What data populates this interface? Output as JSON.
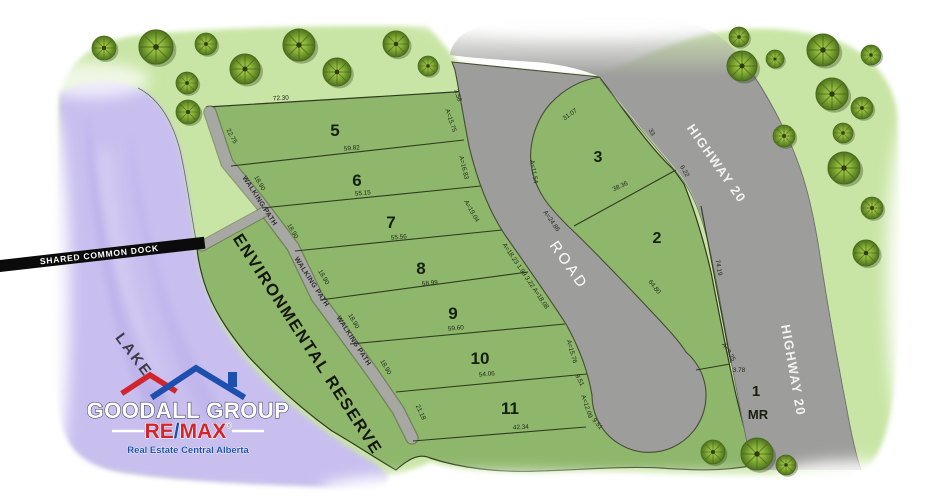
{
  "map": {
    "lake_label": "LAKE",
    "dock_label": "SHARED COMMON DOCK",
    "reserve_label": "ENVIRONMENTAL RESERVE",
    "road_label": "ROAD",
    "highway_labels": [
      {
        "text": "HIGHWAY 20",
        "x": 713,
        "y": 166,
        "r": 55
      },
      {
        "text": "HIGHWAY 20",
        "x": 789,
        "y": 371,
        "r": 80
      }
    ],
    "walking_path_labels": [
      {
        "text": "WALKING PATH",
        "x": 258,
        "y": 202,
        "r": 57
      },
      {
        "text": "WALKING PATH",
        "x": 310,
        "y": 283,
        "r": 57
      },
      {
        "text": "WALKING PATH",
        "x": 352,
        "y": 342,
        "r": 57
      }
    ],
    "lots": [
      {
        "number": "5",
        "x": 335,
        "y": 136,
        "s": 17
      },
      {
        "number": "6",
        "x": 357,
        "y": 186,
        "s": 17
      },
      {
        "number": "7",
        "x": 391,
        "y": 228,
        "s": 17
      },
      {
        "number": "8",
        "x": 421,
        "y": 274,
        "s": 17
      },
      {
        "number": "9",
        "x": 453,
        "y": 319,
        "s": 17
      },
      {
        "number": "10",
        "x": 480,
        "y": 364,
        "s": 17
      },
      {
        "number": "11",
        "x": 510,
        "y": 414,
        "s": 17
      },
      {
        "number": "3",
        "x": 598,
        "y": 162,
        "s": 16
      },
      {
        "number": "2",
        "x": 657,
        "y": 243,
        "s": 16
      },
      {
        "number": "1",
        "x": 756,
        "y": 396,
        "s": 15
      },
      {
        "number": "MR",
        "x": 758,
        "y": 419,
        "s": 13
      }
    ],
    "dimensions": [
      {
        "t": "72.30",
        "x": 281,
        "y": 100,
        "r": -4
      },
      {
        "t": "22.75",
        "x": 230,
        "y": 137,
        "r": 62
      },
      {
        "t": "3.58",
        "x": 456,
        "y": 96,
        "r": 72
      },
      {
        "t": "A=15.75",
        "x": 449,
        "y": 121,
        "r": 72
      },
      {
        "t": "59.82",
        "x": 352,
        "y": 150,
        "r": -5
      },
      {
        "t": "A=16.83",
        "x": 462,
        "y": 168,
        "r": 76
      },
      {
        "t": "55.15",
        "x": 363,
        "y": 195,
        "r": -5
      },
      {
        "t": "A=19.04",
        "x": 470,
        "y": 212,
        "r": 60
      },
      {
        "t": "55.56",
        "x": 399,
        "y": 239,
        "r": -5
      },
      {
        "t": "A=18.23 1.99 3.22 A=18.08",
        "x": 524,
        "y": 277,
        "r": 56
      },
      {
        "t": "58.99",
        "x": 430,
        "y": 285,
        "r": -5
      },
      {
        "t": "59.60",
        "x": 456,
        "y": 330,
        "r": -5
      },
      {
        "t": "54.06",
        "x": 487,
        "y": 376,
        "r": -5
      },
      {
        "t": "42.34",
        "x": 521,
        "y": 429,
        "r": -4
      },
      {
        "t": "21.18",
        "x": 419,
        "y": 413,
        "r": 65
      },
      {
        "t": "A=15.76",
        "x": 570,
        "y": 352,
        "r": 74
      },
      {
        "t": "9.51",
        "x": 578,
        "y": 381,
        "r": 62
      },
      {
        "t": "A=12.09",
        "x": 585,
        "y": 407,
        "r": 72
      },
      {
        "t": "9.51",
        "x": 596,
        "y": 425,
        "r": 50
      },
      {
        "t": "18.90",
        "x": 258,
        "y": 184,
        "r": 60
      },
      {
        "t": "18.90",
        "x": 291,
        "y": 232,
        "r": 60
      },
      {
        "t": "18.90",
        "x": 322,
        "y": 278,
        "r": 60
      },
      {
        "t": "18.90",
        "x": 352,
        "y": 322,
        "r": 60
      },
      {
        "t": "18.90",
        "x": 384,
        "y": 368,
        "r": 60
      },
      {
        "t": "31.07",
        "x": 571,
        "y": 116,
        "r": -35
      },
      {
        "t": "33",
        "x": 650,
        "y": 133,
        "r": 62
      },
      {
        "t": "A=11.54",
        "x": 532,
        "y": 172,
        "r": 80
      },
      {
        "t": "A=24.86",
        "x": 550,
        "y": 222,
        "r": 55
      },
      {
        "t": "38.36",
        "x": 621,
        "y": 188,
        "r": -25
      },
      {
        "t": "6.22",
        "x": 683,
        "y": 172,
        "r": 60
      },
      {
        "t": "64.80",
        "x": 653,
        "y": 288,
        "r": 52
      },
      {
        "t": "74.19",
        "x": 717,
        "y": 268,
        "r": 80
      },
      {
        "t": "A=9.25",
        "x": 727,
        "y": 353,
        "r": 58
      },
      {
        "t": "3.78",
        "x": 739,
        "y": 372,
        "r": 0
      }
    ],
    "trees": [
      {
        "x": 104,
        "y": 48,
        "r": 12
      },
      {
        "x": 156,
        "y": 47,
        "r": 17
      },
      {
        "x": 206,
        "y": 44,
        "r": 11
      },
      {
        "x": 245,
        "y": 69,
        "r": 15
      },
      {
        "x": 187,
        "y": 83,
        "r": 11
      },
      {
        "x": 299,
        "y": 45,
        "r": 16
      },
      {
        "x": 337,
        "y": 72,
        "r": 14
      },
      {
        "x": 396,
        "y": 44,
        "r": 13
      },
      {
        "x": 428,
        "y": 66,
        "r": 10
      },
      {
        "x": 188,
        "y": 112,
        "r": 12
      },
      {
        "x": 739,
        "y": 37,
        "r": 10
      },
      {
        "x": 742,
        "y": 66,
        "r": 15
      },
      {
        "x": 775,
        "y": 59,
        "r": 9
      },
      {
        "x": 823,
        "y": 50,
        "r": 16
      },
      {
        "x": 871,
        "y": 55,
        "r": 10
      },
      {
        "x": 832,
        "y": 94,
        "r": 16
      },
      {
        "x": 862,
        "y": 108,
        "r": 11
      },
      {
        "x": 784,
        "y": 136,
        "r": 11
      },
      {
        "x": 843,
        "y": 133,
        "r": 10
      },
      {
        "x": 844,
        "y": 168,
        "r": 16
      },
      {
        "x": 872,
        "y": 208,
        "r": 11
      },
      {
        "x": 866,
        "y": 253,
        "r": 13
      },
      {
        "x": 713,
        "y": 452,
        "r": 12
      },
      {
        "x": 757,
        "y": 454,
        "r": 16
      },
      {
        "x": 786,
        "y": 465,
        "r": 10
      }
    ]
  },
  "logo": {
    "line1": "GOODALL GROUP",
    "remax_re": "RE",
    "remax_slash": "/",
    "remax_max": "MAX",
    "registered": "®",
    "tagline": "Real Estate Central Alberta"
  },
  "colors": {
    "lot_green": "#8eb76b",
    "land_green": "#c9e5a5",
    "lake_purple": "#c8bfef",
    "road_gray": "#9d9d9b",
    "path_gray": "#a7a7a3",
    "outline_green": "#2f3a20",
    "remax_red": "#d1242b",
    "remax_blue": "#1d4fae",
    "dock_black": "#0b0b0b",
    "label_white": "#f2f2ef"
  }
}
